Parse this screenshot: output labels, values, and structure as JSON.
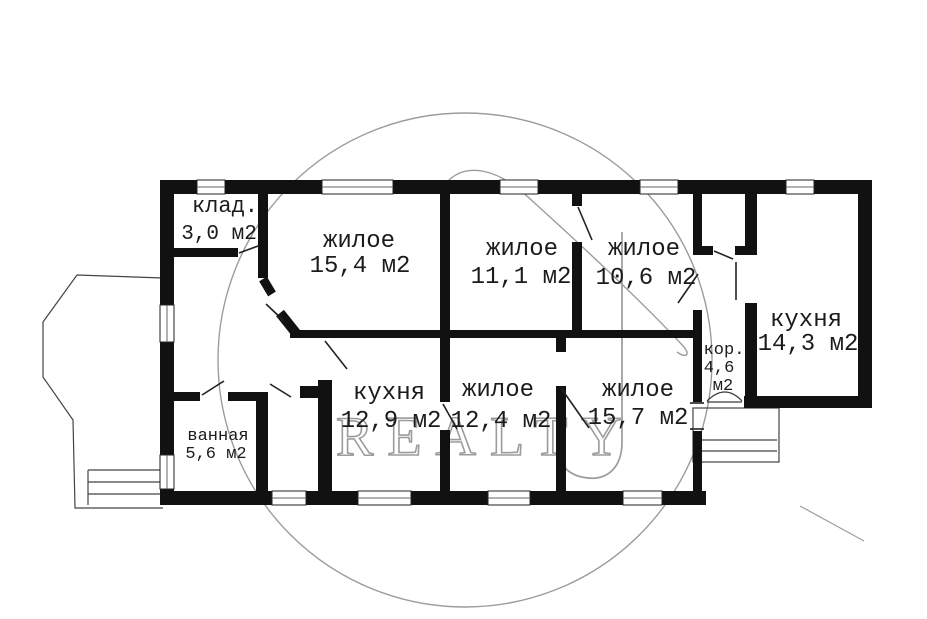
{
  "plan": {
    "rooms": [
      {
        "id": "storage",
        "label": "клад.",
        "area": "3,0 м2"
      },
      {
        "id": "living-15-4",
        "label": "жилое",
        "area": "15,4 м2"
      },
      {
        "id": "living-11-1",
        "label": "жилое",
        "area": "11,1 м2"
      },
      {
        "id": "living-10-6",
        "label": "жилое",
        "area": "10,6 м2"
      },
      {
        "id": "kitchen-14-3",
        "label": "кухня",
        "area": "14,3 м2"
      },
      {
        "id": "corridor",
        "label": "кор.",
        "area": "4,6",
        "area_unit": "м2"
      },
      {
        "id": "kitchen-12-9",
        "label": "кухня",
        "area": "12,9 м2"
      },
      {
        "id": "living-12-4",
        "label": "жилое",
        "area": "12,4 м2"
      },
      {
        "id": "living-15-7",
        "label": "жилое",
        "area": "15,7 м2"
      },
      {
        "id": "bathroom",
        "label": "ванная",
        "area": "5,6 м2"
      }
    ],
    "watermark": {
      "text": "REALTY",
      "monogram": "J",
      "color": "#9c9c9c"
    },
    "colors": {
      "wall": "#111111",
      "background": "#ffffff",
      "label": "#1b1b1b"
    }
  }
}
